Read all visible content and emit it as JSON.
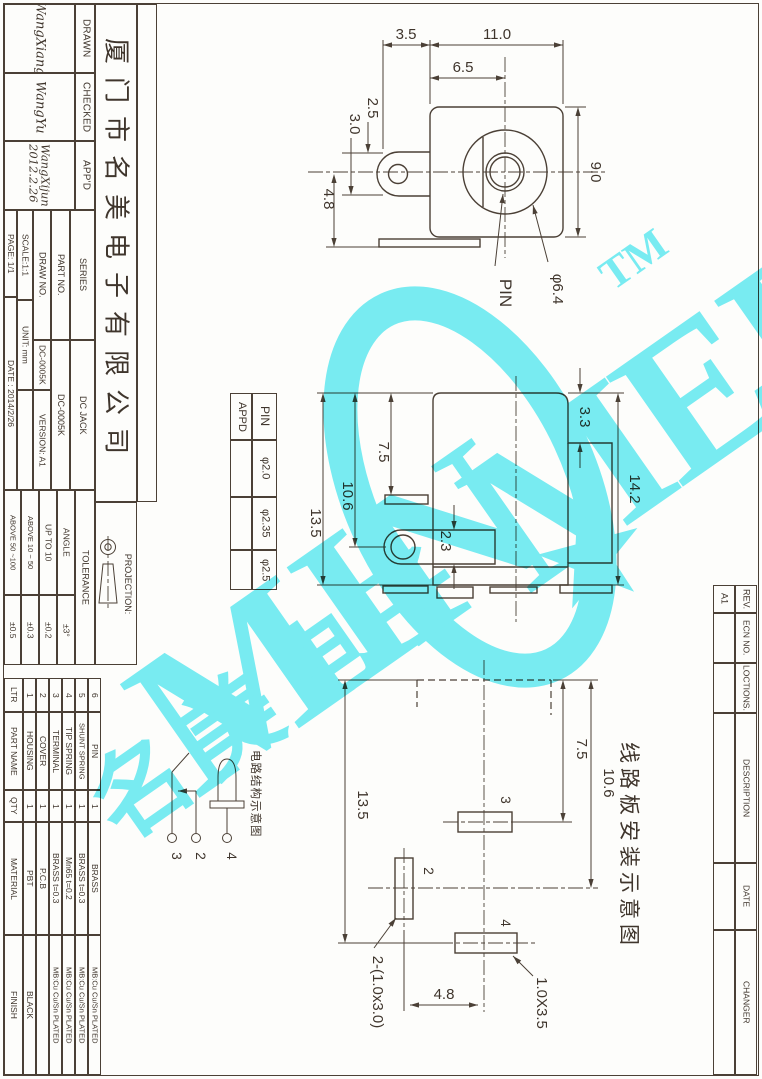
{
  "company": "厦门市名美电子有限公司",
  "approvals": {
    "drawn_label": "DRAWN",
    "drawn_sig": "WangXiang",
    "checked_label": "CHECKED",
    "checked_sig": "WangYu",
    "appd_label": "APP'D",
    "appd_sig": "WangXijun",
    "appd_sig_date": "2012.2.26"
  },
  "fields": {
    "series_label": "SERIES",
    "series_value": "DC JACK",
    "part_label": "PART NO.",
    "part_value": "DC-0005K",
    "draw_label": "DRAW NO.",
    "draw_value": "DC-0005K",
    "version": "VERSION: A1",
    "scale": "SCALE:1:1",
    "unit": "UNIT: mm",
    "page": "PAGE: 1/1",
    "date": "DATE : 2014/2/26"
  },
  "tolerance": {
    "header": "TOLERANCE",
    "projection_label": "PROJECTION:",
    "rows": [
      {
        "label": "ANGLE",
        "value": "±3°"
      },
      {
        "label": "UP TO 10",
        "value": "±0.2"
      },
      {
        "label": "ABOVE 10 ~ 50",
        "value": "±0.3"
      },
      {
        "label": "ABOVE 50 ~100",
        "value": "±0.5"
      }
    ]
  },
  "bom": {
    "headers": {
      "ltr": "LTR",
      "part": "PART NAME",
      "qty": "QTY",
      "material": "MATERIAL",
      "finish": "FINISH"
    },
    "rows": [
      {
        "no": "1",
        "part": "HOUSING",
        "qty": "1",
        "material": "PBT",
        "finish": "BLACK"
      },
      {
        "no": "2",
        "part": "COVER",
        "qty": "1",
        "material": "P.C.B",
        "finish": ""
      },
      {
        "no": "3",
        "part": "TERMINAL",
        "qty": "1",
        "material": "BRASS t=0.3",
        "finish": "MB:Cu Cu/Sn PLATED"
      },
      {
        "no": "4",
        "part": "TIP SPRING",
        "qty": "1",
        "material": "Mn65 t=0.2",
        "finish": "MB:Cu Cu/Sn PLATED"
      },
      {
        "no": "5",
        "part": "SHUNT SPRING",
        "qty": "1",
        "material": "BRASS t=0.3",
        "finish": "MB:Cu Cu/Sn PLATED"
      },
      {
        "no": "6",
        "part": "PIN",
        "qty": "1",
        "material": "BRASS",
        "finish": "MB:Cu Cu/Sn PLATED"
      }
    ]
  },
  "revisions": {
    "rev_label": "REV.",
    "rev_value": "A1",
    "ecn_label": "ECN NO.",
    "locations_label": "LOCTIONS.",
    "description_label": "DESCRIPTION",
    "date_label": "DATE",
    "changer_label": "CHANGER"
  },
  "front_view": {
    "dims": {
      "d35": "3.5",
      "d110": "11.0",
      "d65": "6.5",
      "d25": "2.5",
      "d30": "3.0",
      "d48": "4.8",
      "d90": "9.0",
      "dia64": "φ6.4",
      "pin_label": "PIN"
    }
  },
  "side_view": {
    "dims": {
      "d33": "3.3",
      "d142": "14.2",
      "d75": "7.5",
      "d106": "10.6",
      "d135": "13.5",
      "d23": "2.3"
    },
    "pin_table": {
      "col_pin": "PIN",
      "col_appd": "APPD",
      "rows": [
        "φ2.0",
        "φ2.35",
        "φ2.5"
      ]
    }
  },
  "pcb_view": {
    "title": "线路板安装示意图",
    "dims": {
      "d75": "7.5",
      "d106": "10.6",
      "d135": "13.5",
      "d48": "4.8",
      "slot2": "2-(1.0x3.0)",
      "slot4": "1.0X3.5"
    },
    "pads": {
      "p2": "2",
      "p3": "3",
      "p4": "4"
    }
  },
  "schematic": {
    "caption": "电路结构示意图",
    "pins": {
      "p2": "2",
      "p3": "3",
      "p4": "4"
    }
  },
  "watermark": {
    "text_min": "MIN",
    "text_mei": "MEI",
    "tm": "TM",
    "cjk": "名美电子",
    "star": "★",
    "color": "#79edf5"
  }
}
